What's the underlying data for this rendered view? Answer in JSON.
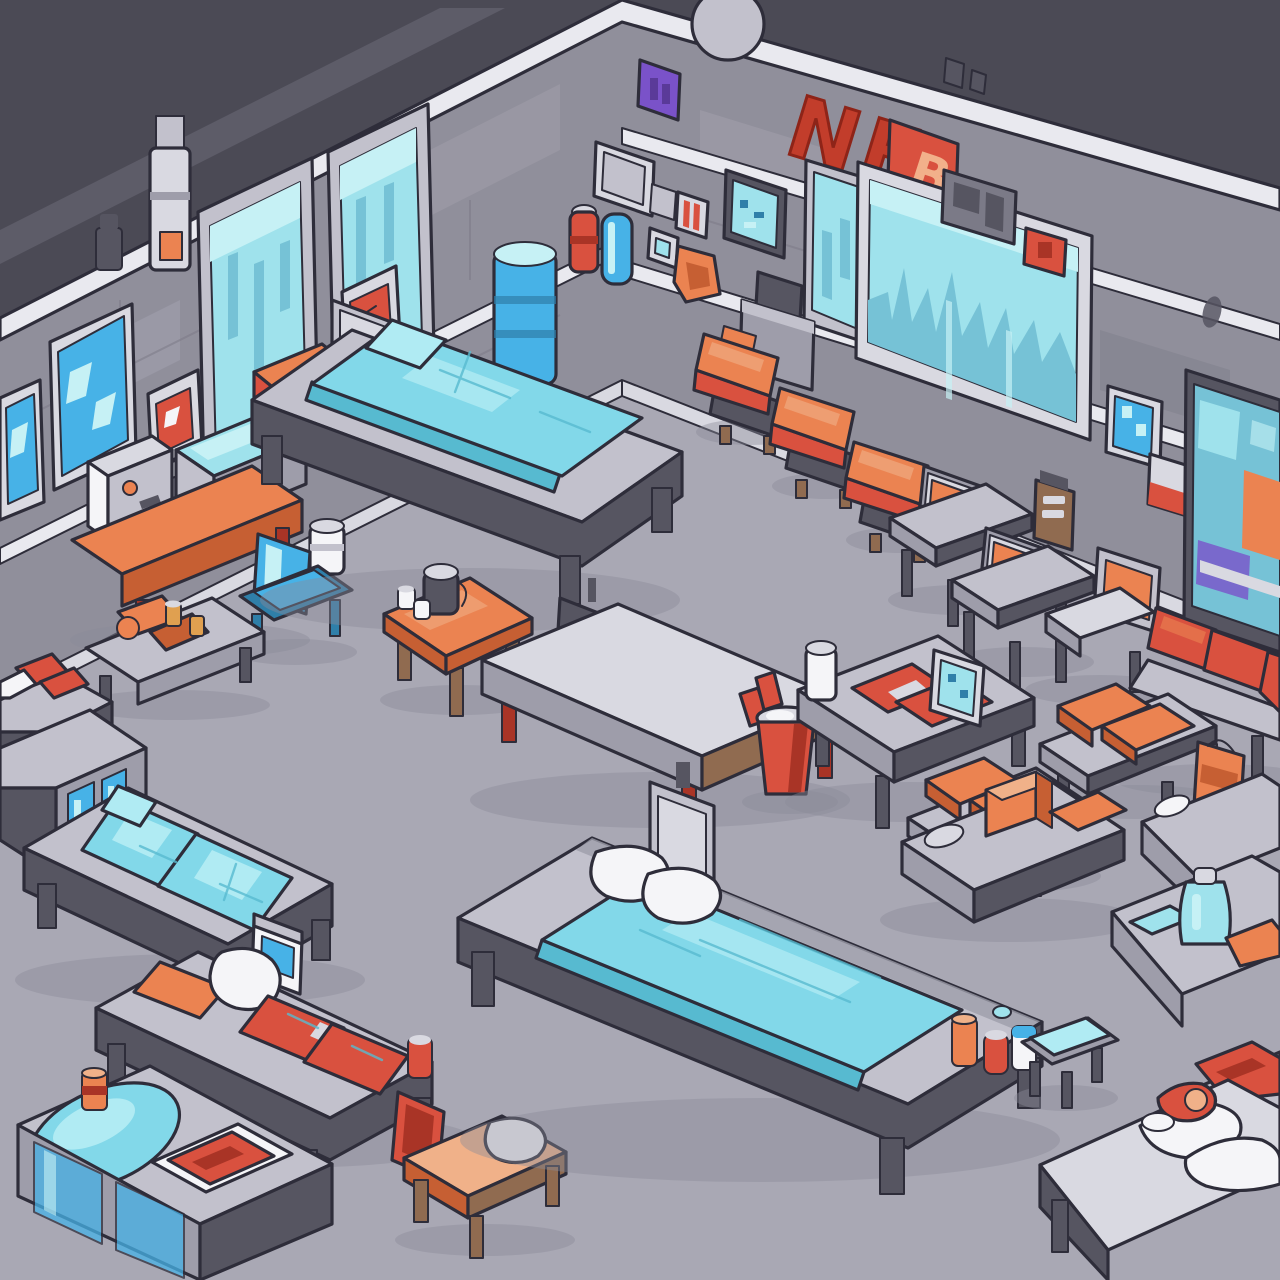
{
  "scene": {
    "title": "Isometric sci-fi dormitory ward",
    "room_type": "dormitory-ward",
    "style": "isometric cartoon game art",
    "walls": 2,
    "beds": 7,
    "stools": 4,
    "benches": 6,
    "tables": 7
  },
  "signs": {
    "wall_sign_1": "NE",
    "wall_sign_2": "B"
  },
  "palette": {
    "ink": "#2e2d3a",
    "floor": "#a9a8b4",
    "shadow": "#8b8a98",
    "ceil": "#4b4a55",
    "ceil2": "#5d5c68",
    "wall": "#908f9b",
    "wallhi": "#a3a2ae",
    "walllo": "#7b7a87",
    "trim": "#e9e9ef",
    "off": "#d9d9e1",
    "gray1": "#c2c1cc",
    "gray2": "#9e9daa",
    "gray3": "#565561",
    "glass": "#9fe2ec",
    "glasshi": "#c6f1f5",
    "glassdk": "#76c2d6",
    "cyan": "#82d8e9",
    "cyanhi": "#b0ebf3",
    "cyandk": "#57bad0",
    "blue": "#47b2e7",
    "bluedk": "#2f7fa9",
    "red": "#d9513f",
    "reddk": "#a93426",
    "orange": "#eb8351",
    "orangedk": "#c65f33",
    "peach": "#f0b189",
    "white": "#f5f5f8",
    "brown": "#906b50",
    "amber": "#e0a050",
    "purple": "#7a52c9",
    "purpledk": "#5a3a99",
    "signred": "#c23d2b",
    "signdk": "#8e2418",
    "signletter": "#f2b08a"
  },
  "objects": [
    "floor",
    "ceiling",
    "left-wall",
    "back-wall",
    "window",
    "city-window",
    "picture-frame",
    "red-switch-panel",
    "red-supply-cabinet",
    "wall-pipe",
    "purple-sign",
    "wall-monitor",
    "fire-extinguisher",
    "towel-roll",
    "soap-dispenser",
    "supply-bag",
    "letter-sign",
    "wall-mural",
    "bed",
    "mattress",
    "pillow",
    "stool",
    "desk",
    "chair",
    "bench",
    "table",
    "kettle",
    "water-jug",
    "storage-bucket",
    "display-case",
    "coffee-machine",
    "cooler-box"
  ]
}
